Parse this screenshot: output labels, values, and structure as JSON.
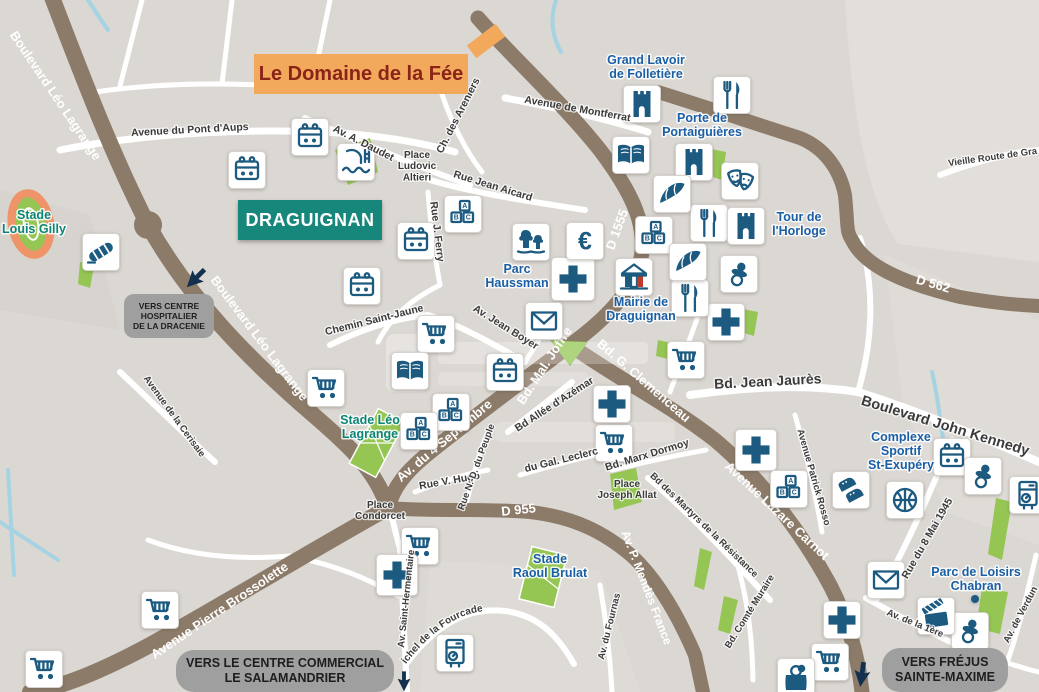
{
  "banner": {
    "label": "Le Domaine de la Fée"
  },
  "city_label": "DRAGUIGNAN",
  "badges": [
    {
      "id": "hospital",
      "lines": [
        "VERS CENTRE",
        "HOSPITALIER",
        "DE LA DRACENIE"
      ]
    },
    {
      "id": "mall",
      "lines": [
        "VERS LE CENTRE COMMERCIAL",
        "LE SALAMANDRIER"
      ]
    },
    {
      "id": "frejus",
      "lines": [
        "VERS FRÉJUS",
        "SAINTE-MAXIME"
      ]
    }
  ],
  "map": {
    "poi_labels": [
      {
        "lines": [
          "Grand Lavoir",
          "de Folletière"
        ],
        "x": 646,
        "y": 64,
        "color": "navy"
      },
      {
        "lines": [
          "Porte de",
          "Portaiguières"
        ],
        "x": 702,
        "y": 122,
        "color": "navy"
      },
      {
        "lines": [
          "Tour de",
          "l'Horloge"
        ],
        "x": 799,
        "y": 221,
        "color": "navy"
      },
      {
        "lines": [
          "Parc",
          "Haussman"
        ],
        "x": 517,
        "y": 273,
        "color": "navy"
      },
      {
        "lines": [
          "Mairie de",
          "Draguignan"
        ],
        "x": 641,
        "y": 306,
        "color": "navy"
      },
      {
        "lines": [
          "Complexe",
          "Sportif",
          "St-Exupéry"
        ],
        "x": 901,
        "y": 441,
        "color": "navy"
      },
      {
        "lines": [
          "Parc de Loisirs",
          "Chabran"
        ],
        "x": 976,
        "y": 576,
        "color": "navy"
      },
      {
        "lines": [
          "Stade Léo",
          "Lagrange"
        ],
        "x": 370,
        "y": 424,
        "color": "teal"
      },
      {
        "lines": [
          "Stade",
          "Louis Gilly"
        ],
        "x": 34,
        "y": 219,
        "color": "teal"
      },
      {
        "lines": [
          "Stade",
          "Raoul Brulat"
        ],
        "x": 550,
        "y": 563,
        "color": "navy"
      }
    ],
    "street_labels": [
      {
        "text": "Avenue du Pont d'Aups",
        "x": 190,
        "y": 133,
        "rot": -3
      },
      {
        "text": "Av. A. Daudet",
        "x": 362,
        "y": 146,
        "rot": 27
      },
      {
        "text": "Ch. des Areniers",
        "x": 461,
        "y": 117,
        "rot": -63
      },
      {
        "text": "Avenue de Montferrat",
        "x": 577,
        "y": 112,
        "rot": 10
      },
      {
        "text": "Rue Jean Aicard",
        "x": 492,
        "y": 189,
        "rot": 17
      },
      {
        "text": "Rue J. Ferry",
        "x": 434,
        "y": 232,
        "rot": 83
      },
      {
        "text": "Vieille Route de Gra",
        "x": 993,
        "y": 160,
        "rot": -8,
        "size": 9.5
      },
      {
        "text": "Chemin Saint-Jaune",
        "x": 375,
        "y": 323,
        "rot": -14
      },
      {
        "text": "Av. Jean Boyer",
        "x": 504,
        "y": 330,
        "rot": 32
      },
      {
        "text": "Bd.  Jean  Jaurès",
        "x": 768,
        "y": 386,
        "rot": -3,
        "size": 14
      },
      {
        "text": "Boulevard  John  Kennedy",
        "x": 944,
        "y": 430,
        "rot": 17,
        "size": 14.5
      },
      {
        "text": "Avenue de la Cerisaie",
        "x": 172,
        "y": 418,
        "rot": 54,
        "size": 9.5
      },
      {
        "text": "Bd Allée d'Azémar",
        "x": 556,
        "y": 407,
        "rot": -33
      },
      {
        "text": "Rue V. Hugo",
        "x": 450,
        "y": 484,
        "rot": -10
      },
      {
        "text": "Rue N.-D. du Peuple",
        "x": 479,
        "y": 468,
        "rot": -70,
        "size": 9.5
      },
      {
        "text": "du Gal. Leclerc",
        "x": 562,
        "y": 463,
        "rot": -14
      },
      {
        "text": "Bd. Marx Dormoy",
        "x": 648,
        "y": 458,
        "rot": -17
      },
      {
        "text": "Bd des Martyrs de la Résistance",
        "x": 702,
        "y": 527,
        "rot": 44,
        "size": 9.5
      },
      {
        "text": "Avenue Patrick Rosso",
        "x": 811,
        "y": 478,
        "rot": 74,
        "size": 9.5
      },
      {
        "text": "Rue du 8 Mai 1945",
        "x": 930,
        "y": 540,
        "rot": -60
      },
      {
        "text": "Av. Saint-Hermentaire",
        "x": 409,
        "y": 599,
        "rot": -84,
        "size": 9.5
      },
      {
        "text": "Av. du Fournas",
        "x": 612,
        "y": 627,
        "rot": -76,
        "size": 9.5
      },
      {
        "text": "Bd. Comté Muraire",
        "x": 752,
        "y": 613,
        "rot": -58,
        "size": 9.5
      },
      {
        "text": "Av. de la 1ère",
        "x": 914,
        "y": 626,
        "rot": 22,
        "size": 9.5
      },
      {
        "text": "Av. de Verdun",
        "x": 1023,
        "y": 616,
        "rot": -62,
        "size": 9.5
      },
      {
        "text": "Bd du Colonel Michel de la Fourcade",
        "path": "p-fourcade",
        "size": 10
      },
      {
        "lines": [
          "Place",
          "Ludovic",
          "Altieri"
        ],
        "x": 417,
        "y": 158,
        "rot": 0,
        "size": 10
      },
      {
        "lines": [
          "Place",
          "Condorcet"
        ],
        "x": 380,
        "y": 508,
        "rot": 0,
        "size": 10
      },
      {
        "lines": [
          "Place",
          "Joseph Allat"
        ],
        "x": 627,
        "y": 487,
        "rot": 0,
        "size": 10
      }
    ],
    "road_labels": [
      {
        "text": "Boulevard Léo Lagrange",
        "x": 52,
        "y": 98,
        "rot": 56
      },
      {
        "text": "Boulevard Léo Lagrange",
        "x": 256,
        "y": 341,
        "rot": 53
      },
      {
        "text": "Av. du 4 Septembre",
        "x": 447,
        "y": 444,
        "rot": -40
      },
      {
        "text": "Bd. Mal. Joffre",
        "x": 548,
        "y": 368,
        "rot": -57
      },
      {
        "text": "Bd. G. Clemenceau",
        "x": 641,
        "y": 384,
        "rot": 41
      },
      {
        "text": "Avenue Lazare Carnot",
        "x": 774,
        "y": 514,
        "rot": 43
      },
      {
        "text": "Avenue Pierre Brossolette",
        "x": 222,
        "y": 614,
        "rot": -34
      },
      {
        "text": "Av. P. Mendès France",
        "x": 643,
        "y": 589,
        "rot": 69,
        "size": 12
      },
      {
        "text": "D 955",
        "x": 519,
        "y": 514,
        "rot": -6
      },
      {
        "text": "D 1555",
        "x": 621,
        "y": 231,
        "rot": -70
      },
      {
        "text": "D 562",
        "x": 932,
        "y": 288,
        "rot": 16
      }
    ],
    "icons": [
      {
        "type": "calendar",
        "x": 310,
        "y": 137
      },
      {
        "type": "calendar",
        "x": 247,
        "y": 170
      },
      {
        "type": "calendar",
        "x": 416,
        "y": 241
      },
      {
        "type": "calendar",
        "x": 362,
        "y": 286
      },
      {
        "type": "calendar",
        "x": 505,
        "y": 372
      },
      {
        "type": "calendar",
        "x": 952,
        "y": 457
      },
      {
        "type": "cart",
        "x": 326,
        "y": 388
      },
      {
        "type": "cart",
        "x": 436,
        "y": 334
      },
      {
        "type": "cart",
        "x": 614,
        "y": 443
      },
      {
        "type": "cart",
        "x": 686,
        "y": 360
      },
      {
        "type": "cart",
        "x": 420,
        "y": 546
      },
      {
        "type": "cart",
        "x": 160,
        "y": 610
      },
      {
        "type": "cart",
        "x": 44,
        "y": 669
      },
      {
        "type": "cart",
        "x": 830,
        "y": 662
      },
      {
        "type": "cross",
        "x": 573,
        "y": 279,
        "s": 43
      },
      {
        "type": "cross",
        "x": 612,
        "y": 404
      },
      {
        "type": "cross",
        "x": 726,
        "y": 322
      },
      {
        "type": "cross",
        "x": 756,
        "y": 450,
        "s": 41
      },
      {
        "type": "cross",
        "x": 397,
        "y": 575,
        "s": 41
      },
      {
        "type": "cross",
        "x": 842,
        "y": 620
      },
      {
        "type": "book",
        "x": 631,
        "y": 155
      },
      {
        "type": "book",
        "x": 410,
        "y": 371
      },
      {
        "type": "school",
        "x": 463,
        "y": 214
      },
      {
        "type": "school",
        "x": 654,
        "y": 235
      },
      {
        "type": "school",
        "x": 451,
        "y": 412
      },
      {
        "type": "school",
        "x": 419,
        "y": 431
      },
      {
        "type": "school",
        "x": 789,
        "y": 489
      },
      {
        "type": "envelope",
        "x": 544,
        "y": 321
      },
      {
        "type": "envelope",
        "x": 886,
        "y": 580
      },
      {
        "type": "fork-knife",
        "x": 732,
        "y": 95
      },
      {
        "type": "fork-knife",
        "x": 709,
        "y": 223
      },
      {
        "type": "fork-knife",
        "x": 690,
        "y": 298
      },
      {
        "type": "castle",
        "x": 642,
        "y": 104
      },
      {
        "type": "castle",
        "x": 694,
        "y": 162
      },
      {
        "type": "castle",
        "x": 746,
        "y": 226
      },
      {
        "type": "croissant",
        "x": 672,
        "y": 194
      },
      {
        "type": "croissant",
        "x": 688,
        "y": 262
      },
      {
        "type": "masks",
        "x": 740,
        "y": 181
      },
      {
        "type": "pacifier",
        "x": 739,
        "y": 274
      },
      {
        "type": "pacifier",
        "x": 983,
        "y": 476
      },
      {
        "type": "pacifier",
        "x": 970,
        "y": 631
      },
      {
        "type": "euro",
        "x": 585,
        "y": 241
      },
      {
        "type": "trees",
        "x": 531,
        "y": 242
      },
      {
        "type": "pool",
        "x": 356,
        "y": 162
      },
      {
        "type": "bridge",
        "x": 101,
        "y": 252
      },
      {
        "type": "shoes",
        "x": 851,
        "y": 490
      },
      {
        "type": "basketball",
        "x": 905,
        "y": 500
      },
      {
        "type": "cinema",
        "x": 936,
        "y": 616
      },
      {
        "type": "ticket-machine",
        "x": 455,
        "y": 653
      },
      {
        "type": "ticket-machine",
        "x": 1028,
        "y": 495
      },
      {
        "type": "shopping-bag",
        "x": 796,
        "y": 677
      },
      {
        "type": "town-hall",
        "x": 634,
        "y": 277
      },
      {
        "type": "dot",
        "x": 975,
        "y": 599
      }
    ],
    "colors": {
      "background": "#dbd7d3",
      "road_major": "#8c7b69",
      "road_minor": "#ffffff",
      "water": "#a6d3e3",
      "green": "#95c654",
      "track_orange": "#ef9469",
      "icon_navy": "#1d5a80",
      "poi_navy": "#1a5fa5",
      "poi_teal": "#0c8578",
      "banner_bg": "#f2a95c",
      "banner_text": "#8a2418",
      "city_box": "#17877c",
      "badge_gray": "#9f9f9f"
    }
  }
}
